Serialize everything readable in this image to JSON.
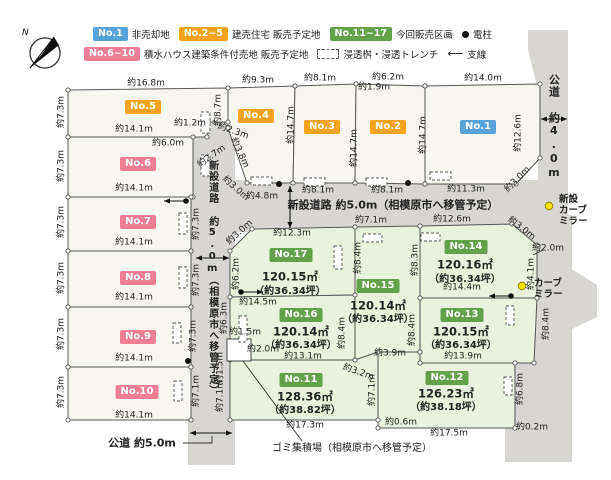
{
  "colors": {
    "road": "#d8d6d2",
    "lot_white": "#f8f6f0",
    "lot_green": "#e9f2dc",
    "line": "#555555",
    "badge_blue": "#55a3d9",
    "badge_orange": "#f5a31c",
    "badge_green": "#61a24b",
    "badge_pink": "#f27e95",
    "mirror_yellow": "#ffe100"
  },
  "compass": {
    "label": "N"
  },
  "legend": {
    "row1": [
      {
        "badge": "No.1",
        "color": "blue",
        "label": "非売却地"
      },
      {
        "badge": "No.2~5",
        "color": "orange",
        "label": "建売住宅 販売予定地"
      },
      {
        "badge": "No.11~17",
        "color": "green",
        "label": "今回販売区画"
      },
      {
        "symbol": "pole",
        "label": "電柱"
      }
    ],
    "row2": [
      {
        "badge": "No.6~10",
        "color": "pink",
        "label": "積水ハウス建築条件付売地 販売予定地"
      },
      {
        "symbol": "trench",
        "label": "浸透桝・浸透トレンチ"
      },
      {
        "symbol": "wire",
        "label": "支線"
      }
    ]
  },
  "roads": [
    {
      "name": "new-road-vertical",
      "pts": [
        [
          188,
          120
        ],
        [
          235,
          120
        ],
        [
          235,
          465
        ],
        [
          188,
          465
        ]
      ]
    },
    {
      "name": "new-road-horizontal",
      "pts": [
        [
          188,
          180
        ],
        [
          550,
          180
        ],
        [
          550,
          232
        ],
        [
          188,
          232
        ]
      ]
    },
    {
      "name": "public-road-right",
      "pts": [
        [
          528,
          30
        ],
        [
          568,
          30
        ],
        [
          568,
          462
        ],
        [
          538,
          462
        ],
        [
          538,
          90
        ],
        [
          528,
          50
        ]
      ]
    },
    {
      "name": "public-road-right-lower",
      "pts": [
        [
          505,
          215
        ],
        [
          572,
          215
        ],
        [
          572,
          462
        ],
        [
          505,
          462
        ]
      ]
    },
    {
      "name": "public-road-right-bump",
      "pts": [
        [
          540,
          268
        ],
        [
          570,
          268
        ],
        [
          597,
          285
        ],
        [
          597,
          317
        ],
        [
          570,
          330
        ],
        [
          540,
          330
        ]
      ]
    }
  ],
  "road_labels": [
    {
      "text": "新設道路 約5.0m（相模原市へ移管予定）",
      "x": 393,
      "y": 206,
      "vertical": false,
      "size": 11,
      "bold": true
    },
    {
      "text": "新設道路 約5.0m（相模原市へ移管予定）",
      "x": 212,
      "y": 278,
      "vertical": true,
      "size": 10,
      "bold": true
    },
    {
      "text": "公道 約4.0m",
      "x": 553,
      "y": 127,
      "vertical": true,
      "size": 11,
      "bold": true
    }
  ],
  "notes": [
    {
      "text": "公道 約5.0m",
      "x": 142,
      "y": 443,
      "size": 11,
      "bold": true
    },
    {
      "text": "ゴミ集積場（相模原市へ移管予定）",
      "x": 352,
      "y": 449,
      "size": 10,
      "bold": false
    }
  ],
  "lots": [
    {
      "id": "No.5",
      "type": "orange",
      "pts": [
        [
          68,
          90
        ],
        [
          228,
          88
        ],
        [
          228,
          122
        ],
        [
          207,
          122
        ],
        [
          207,
          137
        ],
        [
          68,
          137
        ]
      ],
      "badge": [
        143,
        107
      ]
    },
    {
      "id": "No.6",
      "type": "pink",
      "pts": [
        [
          68,
          137
        ],
        [
          193,
          137
        ],
        [
          193,
          197
        ],
        [
          68,
          197
        ]
      ],
      "badge": [
        138,
        164
      ]
    },
    {
      "id": "No.7",
      "type": "pink",
      "pts": [
        [
          68,
          197
        ],
        [
          191,
          197
        ],
        [
          191,
          251
        ],
        [
          68,
          251
        ]
      ],
      "badge": [
        138,
        222
      ]
    },
    {
      "id": "No.8",
      "type": "pink",
      "pts": [
        [
          68,
          251
        ],
        [
          191,
          251
        ],
        [
          191,
          307
        ],
        [
          68,
          307
        ]
      ],
      "badge": [
        138,
        278
      ]
    },
    {
      "id": "No.9",
      "type": "pink",
      "pts": [
        [
          68,
          307
        ],
        [
          191,
          307
        ],
        [
          191,
          367
        ],
        [
          68,
          367
        ]
      ],
      "badge": [
        138,
        337
      ]
    },
    {
      "id": "No.10",
      "type": "pink",
      "pts": [
        [
          68,
          367
        ],
        [
          191,
          367
        ],
        [
          191,
          420
        ],
        [
          68,
          420
        ]
      ],
      "badge": [
        137,
        392
      ]
    },
    {
      "id": "No.4",
      "type": "orange",
      "pts": [
        [
          228,
          88
        ],
        [
          295,
          86
        ],
        [
          293,
          183
        ],
        [
          247,
          183
        ],
        [
          228,
          128
        ]
      ],
      "badge": [
        256,
        116
      ]
    },
    {
      "id": "No.3",
      "type": "orange",
      "pts": [
        [
          295,
          86
        ],
        [
          356,
          84
        ],
        [
          355,
          183
        ],
        [
          293,
          183
        ]
      ],
      "badge": [
        322,
        127
      ]
    },
    {
      "id": "No.2",
      "type": "orange",
      "pts": [
        [
          356,
          84
        ],
        [
          425,
          86
        ],
        [
          425,
          184
        ],
        [
          355,
          183
        ]
      ],
      "badge": [
        388,
        127
      ]
    },
    {
      "id": "No.1",
      "type": "blue",
      "pts": [
        [
          425,
          86
        ],
        [
          540,
          84
        ],
        [
          540,
          158
        ],
        [
          516,
          184
        ],
        [
          425,
          184
        ]
      ],
      "badge": [
        478,
        127
      ]
    },
    {
      "id": "No.17",
      "type": "green",
      "pts": [
        [
          252,
          229
        ],
        [
          355,
          227
        ],
        [
          355,
          295
        ],
        [
          230,
          297
        ],
        [
          230,
          251
        ]
      ],
      "badge": [
        291,
        255
      ],
      "area": "120.15㎡",
      "area_xy": [
        290,
        277
      ],
      "tsubo": "（約36.34坪）",
      "tsubo_xy": [
        290,
        292
      ]
    },
    {
      "id": "No.15",
      "type": "green",
      "pts": [
        [
          355,
          227
        ],
        [
          420,
          226
        ],
        [
          420,
          352
        ],
        [
          378,
          352
        ],
        [
          355,
          360
        ]
      ],
      "badge": [
        378,
        286
      ],
      "area": "120.14㎡",
      "area_xy": [
        378,
        306
      ],
      "tsubo": "（約36.34坪）",
      "tsubo_xy": [
        378,
        320
      ]
    },
    {
      "id": "No.14",
      "type": "green",
      "pts": [
        [
          420,
          226
        ],
        [
          512,
          224
        ],
        [
          537,
          245
        ],
        [
          537,
          298
        ],
        [
          420,
          298
        ]
      ],
      "badge": [
        466,
        247
      ],
      "area": "120.16㎡",
      "area_xy": [
        465,
        265
      ],
      "tsubo": "（約36.34坪）",
      "tsubo_xy": [
        465,
        280
      ]
    },
    {
      "id": "No.16",
      "type": "green",
      "pts": [
        [
          230,
          297
        ],
        [
          355,
          295
        ],
        [
          355,
          360
        ],
        [
          230,
          360
        ]
      ],
      "badge": [
        301,
        315
      ],
      "area": "120.14㎡",
      "area_xy": [
        301,
        332
      ],
      "tsubo": "（約36.34坪）",
      "tsubo_xy": [
        301,
        346
      ]
    },
    {
      "id": "No.13",
      "type": "green",
      "pts": [
        [
          420,
          298
        ],
        [
          537,
          298
        ],
        [
          534,
          363
        ],
        [
          420,
          363
        ]
      ],
      "badge": [
        462,
        315
      ],
      "area": "120.15㎡",
      "area_xy": [
        461,
        332
      ],
      "tsubo": "（約36.34坪）",
      "tsubo_xy": [
        461,
        346
      ]
    },
    {
      "id": "No.11",
      "type": "green",
      "pts": [
        [
          230,
          360
        ],
        [
          355,
          360
        ],
        [
          378,
          352
        ],
        [
          378,
          420
        ],
        [
          230,
          420
        ]
      ],
      "badge": [
        301,
        380
      ],
      "area": "128.36㎡",
      "area_xy": [
        305,
        397
      ],
      "tsubo": "（約38.82坪）",
      "tsubo_xy": [
        305,
        411
      ]
    },
    {
      "id": "No.12",
      "type": "green",
      "pts": [
        [
          378,
          352
        ],
        [
          420,
          352
        ],
        [
          420,
          363
        ],
        [
          515,
          363
        ],
        [
          515,
          428
        ],
        [
          378,
          428
        ]
      ],
      "badge": [
        447,
        378
      ],
      "area": "126.23㎡",
      "area_xy": [
        446,
        394
      ],
      "tsubo": "（約38.18坪）",
      "tsubo_xy": [
        446,
        408
      ]
    }
  ],
  "dims": [
    [
      "約16.8m",
      146,
      84,
      0
    ],
    [
      "約7.3m",
      62,
      112,
      -90
    ],
    [
      "約14.1m",
      134,
      130,
      0
    ],
    [
      "約1.2m",
      190,
      124,
      0
    ],
    [
      "約6.0m",
      168,
      144,
      0
    ],
    [
      "約8.7m",
      219,
      110,
      -90
    ],
    [
      "約9.3m",
      258,
      81,
      0
    ],
    [
      "約2.3m",
      233,
      132,
      20
    ],
    [
      "約7.3m",
      62,
      166,
      -90
    ],
    [
      "約14.1m",
      134,
      189,
      0
    ],
    [
      "約2.7m",
      212,
      157,
      -35
    ],
    [
      "約3.8m",
      239,
      153,
      65
    ],
    [
      "約3.0m",
      235,
      189,
      42
    ],
    [
      "約4.8m",
      262,
      197,
      0
    ],
    [
      "約14.7m",
      292,
      125,
      -90
    ],
    [
      "約8.1m",
      320,
      79,
      0
    ],
    [
      "約14.7m",
      355,
      148,
      -90
    ],
    [
      "約6.2m",
      388,
      78,
      0
    ],
    [
      "約1.9m",
      374,
      88,
      0
    ],
    [
      "約14.7m",
      424,
      135,
      -90
    ],
    [
      "約14.0m",
      483,
      79,
      0
    ],
    [
      "約12.6m",
      519,
      133,
      -90
    ],
    [
      "約11.3m",
      466,
      190,
      0
    ],
    [
      "約8.1m",
      318,
      191,
      0
    ],
    [
      "約8.1m",
      387,
      191,
      0
    ],
    [
      "約3.0m",
      518,
      180,
      -45
    ],
    [
      "約7.3m",
      62,
      222,
      -90
    ],
    [
      "約14.1m",
      134,
      243,
      0
    ],
    [
      "約7.3m",
      197,
      224,
      -90
    ],
    [
      "約7.3m",
      62,
      278,
      -90
    ],
    [
      "約14.1m",
      134,
      298,
      0
    ],
    [
      "約7.3m",
      197,
      280,
      -90
    ],
    [
      "約7.3m",
      62,
      334,
      -90
    ],
    [
      "約14.1m",
      134,
      359,
      0
    ],
    [
      "約7.3m",
      194,
      336,
      -90
    ],
    [
      "約7.3m",
      62,
      392,
      -90
    ],
    [
      "約14.1m",
      134,
      416,
      0
    ],
    [
      "約7.1m",
      197,
      391,
      -90
    ],
    [
      "約12.3m",
      292,
      234,
      0
    ],
    [
      "約3.0m",
      240,
      233,
      -42
    ],
    [
      "約7.1m",
      371,
      221,
      0
    ],
    [
      "約12.6m",
      452,
      220,
      0
    ],
    [
      "約3.0m",
      521,
      229,
      38
    ],
    [
      "約2.0m",
      548,
      249,
      0
    ],
    [
      "約8.4m",
      359,
      258,
      -90
    ],
    [
      "約8.3m",
      416,
      260,
      -90
    ],
    [
      "約6.2m",
      237,
      274,
      -90
    ],
    [
      "約6.3m",
      225,
      318,
      -90
    ],
    [
      "約14.5m",
      258,
      303,
      0
    ],
    [
      "約14.4m",
      462,
      288,
      0
    ],
    [
      "約8.4m",
      413,
      330,
      -90
    ],
    [
      "約8.4m",
      343,
      333,
      -90
    ],
    [
      "約8.4m",
      547,
      324,
      -90
    ],
    [
      "約4.1m",
      532,
      274,
      -90
    ],
    [
      "約13.1m",
      303,
      357,
      0
    ],
    [
      "約13.9m",
      463,
      357,
      0
    ],
    [
      "約3.9m",
      390,
      354,
      0
    ],
    [
      "約3.2m",
      358,
      373,
      20
    ],
    [
      "約1.5m",
      245,
      333,
      0
    ],
    [
      "約2.0m",
      263,
      350,
      0
    ],
    [
      "約1.5m",
      221,
      368,
      -90
    ],
    [
      "約7.1m",
      221,
      396,
      -90
    ],
    [
      "約7.1m",
      373,
      390,
      -90
    ],
    [
      "約17.3m",
      305,
      426,
      0
    ],
    [
      "約0.6m",
      401,
      423,
      0
    ],
    [
      "約17.5m",
      449,
      434,
      0
    ],
    [
      "約6.8m",
      521,
      389,
      -90
    ],
    [
      "約0.2m",
      532,
      428,
      0
    ]
  ],
  "arrows_double": [
    [
      290,
      186,
      290,
      228
    ],
    [
      196,
      258,
      229,
      258
    ],
    [
      541,
      119,
      567,
      119
    ],
    [
      190,
      433,
      232,
      433
    ]
  ],
  "wires": [
    [
      186,
      201,
      -1
    ],
    [
      241,
      292,
      1
    ],
    [
      511,
      296,
      -1
    ]
  ],
  "poles": [
    [
      279,
      184
    ],
    [
      408,
      183
    ],
    [
      188,
      361
    ]
  ],
  "mirrors": [
    {
      "dot": [
        549,
        206
      ],
      "lines": [
        "新設",
        "カーブ",
        "ミラー"
      ],
      "xy": [
        559,
        194
      ]
    },
    {
      "dot": [
        522,
        286
      ],
      "lines": [
        "カーブ",
        "ミラー"
      ],
      "xy": [
        534,
        278
      ]
    }
  ],
  "trenches": [
    [
      201,
      112,
      9,
      21
    ],
    [
      201,
      155,
      9,
      21
    ],
    [
      179,
      213,
      8,
      21
    ],
    [
      179,
      267,
      8,
      21
    ],
    [
      173,
      323,
      8,
      20
    ],
    [
      174,
      381,
      8,
      20
    ],
    [
      334,
      246,
      8,
      23
    ],
    [
      239,
      316,
      8,
      26
    ],
    [
      506,
      306,
      8,
      19
    ],
    [
      504,
      377,
      8,
      18
    ],
    [
      251,
      177,
      21,
      8
    ],
    [
      304,
      178,
      21,
      8
    ],
    [
      366,
      178,
      21,
      8
    ],
    [
      430,
      172,
      21,
      8
    ],
    [
      363,
      234,
      19,
      8
    ],
    [
      421,
      233,
      19,
      8
    ]
  ],
  "leaders": [
    [
      [
        243,
        361
      ],
      [
        302,
        441
      ]
    ],
    [
      [
        183,
        443
      ],
      [
        212,
        443
      ],
      [
        212,
        436
      ]
    ],
    [
      [
        533,
        255
      ],
      [
        543,
        250
      ]
    ]
  ],
  "notch": {
    "rect": [
      227,
      339,
      24,
      22
    ]
  }
}
